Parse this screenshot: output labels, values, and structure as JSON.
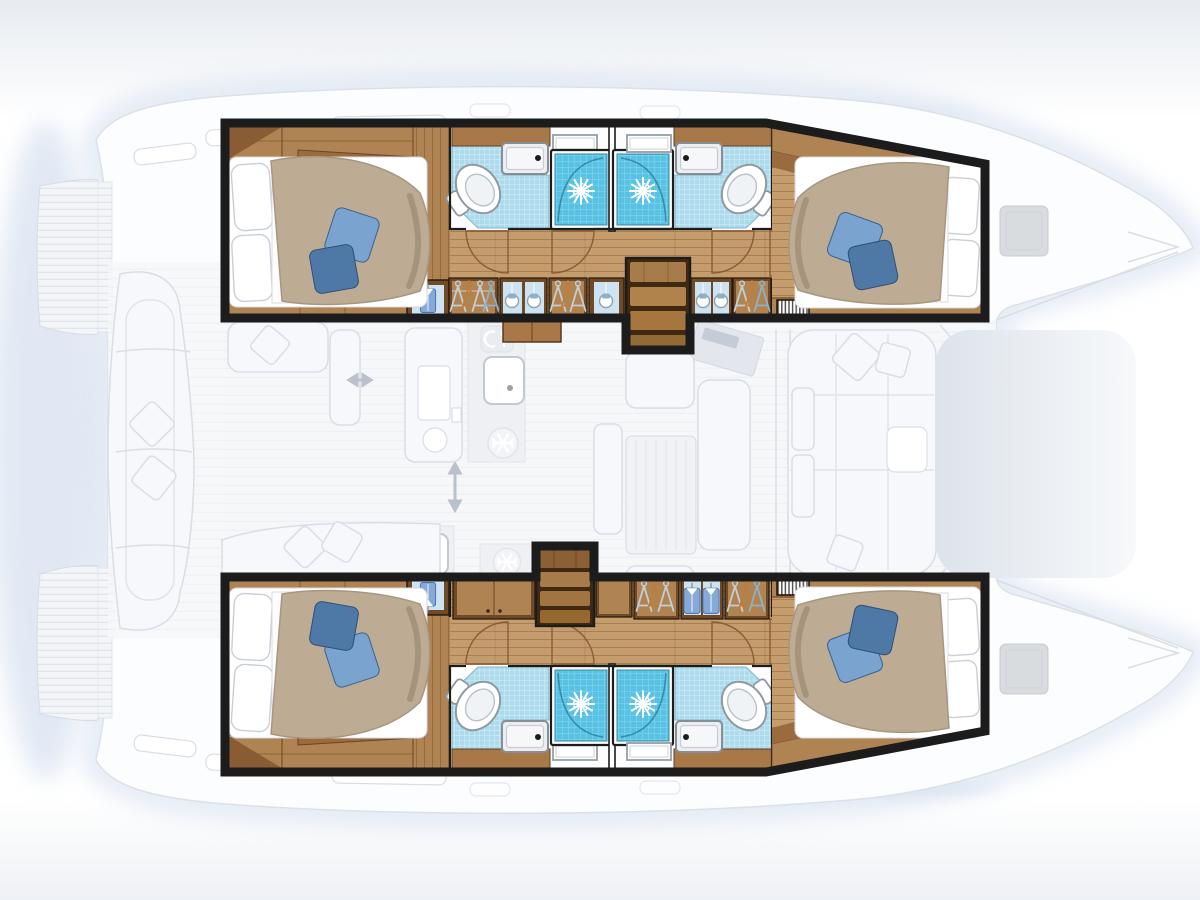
{
  "diagram": {
    "type": "floor-plan",
    "subject": "Catamaran sailing yacht interior layout, top view",
    "layout_summary": "4 double cabins, 4 shower rooms, central saloon with galley, aft cockpit bench, forward sun lounge, twin bows with deck hatches",
    "colors": {
      "outline": "#1c1c1c",
      "wood_floor": "#c59d6d",
      "wood_shelf": "#b08452",
      "wood_furniture": "#a87848",
      "wood_dark": "#7a5330",
      "duvet": "#bdac93",
      "linen": "#ffffff",
      "pillow_blue_light": "#7ba3d0",
      "pillow_blue_dark": "#4e78a6",
      "tile_floor": "#abdbec",
      "shower_blue": "#58c2e4",
      "fixture_outline": "#8f99a1",
      "shirt_blue": "#85aad9",
      "hanger_orange": "#c07c3a",
      "hanger_silver": "#c3ced7",
      "hanger_blue": "#8fb0c9",
      "bag_panel": "#cde3f1",
      "ghost_fill": "#f7f8fb",
      "ghost_line": "#d9dee6",
      "ghost_deep": "#e7ebf1",
      "shadow_blue": "#c9d7eb",
      "teak_fill": "#f3f5f8",
      "teak_line": "#e0e5ea"
    },
    "port_hull": {
      "position": "top",
      "rooms": [
        {
          "name": "aft-double-cabin",
          "features": [
            "double-berth",
            "white-pillows",
            "blue-cushions",
            "shelf-unit",
            "vent-grille",
            "hanging-locker"
          ]
        },
        {
          "name": "aft-shower-room",
          "fixtures": [
            "toilet",
            "washbasin",
            "vanity",
            "shower-cubicle",
            "window"
          ]
        },
        {
          "name": "forward-shower-room",
          "fixtures": [
            "toilet",
            "washbasin",
            "vanity",
            "shower-cubicle",
            "window"
          ]
        },
        {
          "name": "forward-double-cabin",
          "features": [
            "double-berth",
            "white-pillows",
            "blue-cushions",
            "shelf-unit",
            "vent-grille"
          ]
        }
      ],
      "corridor_storage": [
        "hanger-locker",
        "hanging-bags-locker",
        "hanger-locker",
        "hanging-bag-locker",
        "companionway-stairs",
        "hanging-bags-locker",
        "hanger-locker",
        "vent-grille"
      ]
    },
    "starboard_hull": {
      "position": "bottom",
      "rooms": [
        {
          "name": "aft-double-cabin",
          "features": [
            "double-berth",
            "white-pillows",
            "blue-cushions",
            "shelf-unit",
            "vent-grille",
            "shirt-locker"
          ]
        },
        {
          "name": "aft-shower-room",
          "fixtures": [
            "toilet",
            "washbasin",
            "vanity",
            "shower-cubicle",
            "window"
          ]
        },
        {
          "name": "forward-shower-room",
          "fixtures": [
            "toilet",
            "washbasin",
            "vanity",
            "shower-cubicle",
            "window"
          ]
        },
        {
          "name": "forward-double-cabin",
          "features": [
            "double-berth",
            "white-pillows",
            "blue-cushions",
            "shelf-unit",
            "vent-grille"
          ]
        }
      ],
      "corridor_storage": [
        "wood-locker",
        "companionway-stairs",
        "wood-locker",
        "hanger-locker",
        "shirt-locker",
        "hanger-locker"
      ]
    },
    "saloon": {
      "features": [
        "galley-counter",
        "galley-sink",
        "cutlery-icon",
        "refrigerator-snowflake",
        "second-snowflake",
        "island-unit",
        "dinette-table",
        "bench-seats",
        "sliding-door-arrows",
        "tilted-appliance"
      ]
    },
    "cockpit": {
      "features": [
        "curved-bench",
        "seat-cushions",
        "cockpit-table",
        "aft-bench"
      ]
    },
    "foredeck": {
      "features": [
        "sun-lounge",
        "scatter-cushions",
        "lounge-table",
        "deck-hatches"
      ]
    },
    "exterior": {
      "features": [
        "twin-bows",
        "swim-platforms",
        "teak-deck",
        "coachroof-windows"
      ]
    }
  }
}
